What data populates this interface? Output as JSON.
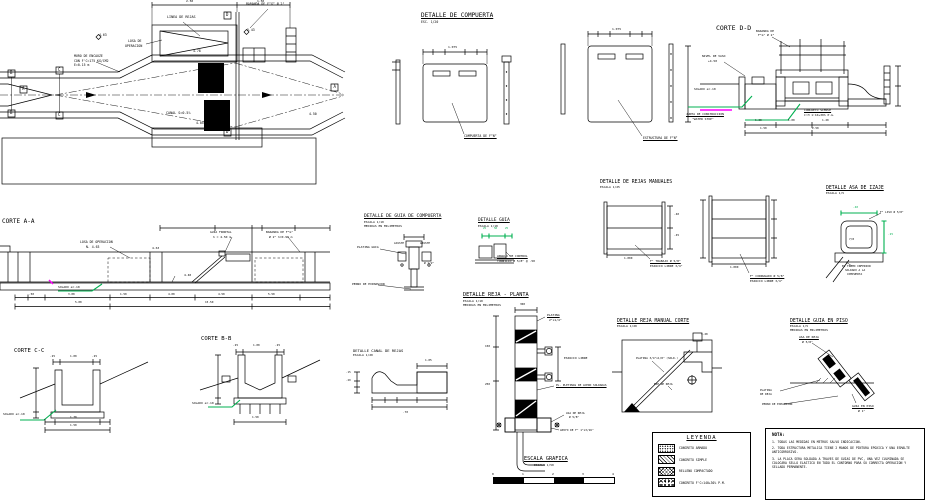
{
  "sheet": {
    "width": 926,
    "height": 501
  },
  "colors": {
    "background": "#ffffff",
    "line": "#000000",
    "green": "#00b050",
    "magenta": "#ff00ff"
  },
  "legend": {
    "title": "LEYENDA",
    "items": [
      {
        "label": "CONCRETO ARMADO",
        "pattern": "stipple"
      },
      {
        "label": "CONCRETO SIMPLE",
        "pattern": "diagonal"
      },
      {
        "label": "RELLENO COMPACTADO",
        "pattern": "crosshatch"
      },
      {
        "label": "CONCRETO F'C=140+30% P.M.",
        "pattern": "rubble"
      }
    ]
  },
  "notes": {
    "title": "NOTA:",
    "items": [
      "1. TODAS LAS MEDIDAS EN METROS SALVO INDICACION.",
      "2. TODA ESTRUCTURA METALICA TIENE 2 MANOS DE PINTURA EPOXICA Y UNA ESMALTE ANTICORROSIVO.",
      "3. LA PLACA SERA SOLDADA A TRAVES DE GUIAS DE PVC, UNA VEZ CULMINADA SE COLOCARA SELLO ELASTICO EN TODO EL CONTORNO PARA SU CORRECTA OPERACION Y SELLADO PERMANENTE."
    ]
  },
  "scale_bar": {
    "ticks": [
      "0",
      "1",
      "2",
      "3",
      "4"
    ]
  },
  "annotations": [
    {
      "n": "title-detalle-de-compuerta",
      "t": "DETALLE DE COMPUERTA",
      "x": 421,
      "y": 13,
      "s": 6,
      "u": 1
    },
    {
      "t": "ESC. 1/20",
      "x": 421,
      "y": 20.5,
      "s": 3.2
    },
    {
      "n": "title-corte-d-d",
      "t": "CORTE D-D",
      "x": 716,
      "y": 25,
      "s": 6.5
    },
    {
      "n": "title-corte-a-a",
      "t": "CORTE A-A",
      "x": 2,
      "y": 219,
      "s": 6
    },
    {
      "n": "title-detalle-de-guia-de-compuerta",
      "t": "DETALLE DE GUIA DE COMPUERTA",
      "x": 364,
      "y": 215,
      "s": 4.6,
      "u": 1
    },
    {
      "t": "ESCALA 1/10",
      "x": 364,
      "y": 221,
      "s": 3
    },
    {
      "t": "MEDIDAS EN MILIMETROS",
      "x": 364,
      "y": 225,
      "s": 3
    },
    {
      "n": "title-detalle-guia",
      "t": "DETALLE GUIA",
      "x": 478,
      "y": 219,
      "s": 4.4,
      "u": 1
    },
    {
      "t": "ESCALA 1/10",
      "x": 478,
      "y": 224.5,
      "s": 3
    },
    {
      "n": "title-detalle-de-rejas-manuales",
      "t": "DETALLE DE REJAS MANUALES",
      "x": 600,
      "y": 180,
      "s": 4.8
    },
    {
      "t": "ESCALA 1/25",
      "x": 600,
      "y": 186,
      "s": 3
    },
    {
      "n": "title-detalle-asa-de-izaje",
      "t": "DETALLE ASA DE IZAJE",
      "x": 826,
      "y": 186,
      "s": 4.8,
      "u": 1
    },
    {
      "t": "ESCALA 1/5",
      "x": 826,
      "y": 192,
      "s": 3
    },
    {
      "n": "title-corte-c-c",
      "t": "CORTE C-C",
      "x": 14,
      "y": 349,
      "s": 5.6
    },
    {
      "n": "title-corte-b-b",
      "t": "CORTE B-B",
      "x": 201,
      "y": 337,
      "s": 5.6
    },
    {
      "n": "title-detalle-canal-de-rejas",
      "t": "DETALLE CANAL DE REJAS",
      "x": 353,
      "y": 349,
      "s": 3.8
    },
    {
      "t": "ESCALA 1/20",
      "x": 353,
      "y": 354,
      "s": 3
    },
    {
      "n": "title-detalle-reja-planta",
      "t": "DETALLE REJA - PLANTA",
      "x": 463,
      "y": 293,
      "s": 5.2,
      "u": 1
    },
    {
      "t": "ESCALA 1/10",
      "x": 463,
      "y": 299.5,
      "s": 3
    },
    {
      "t": "MEDIDAS EN MILIMETROS",
      "x": 463,
      "y": 303.5,
      "s": 3
    },
    {
      "n": "title-detalle-reja-manual-corte",
      "t": "DETALLE REJA MANUAL CORTE",
      "x": 617,
      "y": 319,
      "s": 4.8,
      "u": 1
    },
    {
      "t": "ESCALA 1/20",
      "x": 617,
      "y": 325,
      "s": 3
    },
    {
      "n": "title-detalle-guia-en-piso",
      "t": "DETALLE GUIA EN PISO",
      "x": 790,
      "y": 319,
      "s": 4.8,
      "u": 1
    },
    {
      "t": "ESCALA 1/5",
      "x": 790,
      "y": 325,
      "s": 3
    },
    {
      "t": "MEDIDAS EN MILIMETROS",
      "x": 790,
      "y": 329,
      "s": 3
    },
    {
      "n": "title-escala-grafica",
      "t": "ESCALA GRAFICA",
      "x": 524,
      "y": 457,
      "s": 5.2,
      "u": 1
    },
    {
      "t": "ESCALA 1/50",
      "x": 534,
      "y": 464,
      "s": 3
    },
    {
      "t": "LINEA DE REJAS",
      "x": 167,
      "y": 16,
      "s": 3.4
    },
    {
      "t": "BARANDA DE F°G° Ø 2\"",
      "x": 246,
      "y": 3,
      "s": 3.2
    },
    {
      "t": "LOSA DE",
      "x": 128,
      "y": 40,
      "s": 3.2
    },
    {
      "t": "OPERACION",
      "x": 125,
      "y": 44.5,
      "s": 3.2
    },
    {
      "t": "MURO DE ENCAUZE",
      "x": 74,
      "y": 55,
      "s": 3.2
    },
    {
      "t": "CON F'C=175 KG/CM2",
      "x": 74,
      "y": 59.5,
      "s": 3.2
    },
    {
      "t": "E=0.15 m",
      "x": 74,
      "y": 64,
      "s": 3.2
    },
    {
      "t": "4.63",
      "x": 99,
      "y": 34,
      "s": 3.2
    },
    {
      "t": "5.43",
      "x": 247,
      "y": 29,
      "s": 3.2
    },
    {
      "t": "4.78",
      "x": 193,
      "y": 50,
      "s": 3.2
    },
    {
      "t": "CANAL S=0.5%",
      "x": 166,
      "y": 112,
      "s": 3.4
    },
    {
      "t": "4.05",
      "x": 196,
      "y": 122,
      "s": 3.2
    },
    {
      "t": "4.50",
      "x": 309,
      "y": 113,
      "s": 3.2
    },
    {
      "t": "2.50",
      "x": 186,
      "y": 0,
      "s": 3
    },
    {
      "t": "1.50",
      "x": 257,
      "y": 0,
      "s": 3
    },
    {
      "t": "B",
      "x": 10,
      "y": 70.5,
      "s": 4
    },
    {
      "t": "B",
      "x": 10,
      "y": 110.5,
      "s": 4
    },
    {
      "t": "C",
      "x": 58,
      "y": 67.5,
      "s": 4
    },
    {
      "t": "C",
      "x": 58,
      "y": 112.5,
      "s": 4
    },
    {
      "t": "A",
      "x": 22,
      "y": 86.5,
      "s": 4
    },
    {
      "t": "A",
      "x": 333.5,
      "y": 84.5,
      "s": 4
    },
    {
      "t": "D",
      "x": 226,
      "y": 12.5,
      "s": 4
    },
    {
      "t": "D",
      "x": 226,
      "y": 129.5,
      "s": 4
    },
    {
      "t": "COMPUERTA DE F°N°",
      "x": 464,
      "y": 135,
      "s": 3.2,
      "u": 1
    },
    {
      "t": "ESTRUCTURA DE F°N°",
      "x": 643,
      "y": 137,
      "s": 3.2,
      "u": 1
    },
    {
      "t": "1.075",
      "x": 448,
      "y": 46,
      "s": 3
    },
    {
      "t": "1.075",
      "x": 612,
      "y": 28,
      "s": 3
    },
    {
      "t": "BARANDA DE",
      "x": 756,
      "y": 30,
      "s": 3
    },
    {
      "t": "F°G° Ø 2\"",
      "x": 758,
      "y": 34,
      "s": 3
    },
    {
      "t": "NIVEL DE VASO",
      "x": 702,
      "y": 55,
      "s": 3
    },
    {
      "t": "+4.50",
      "x": 708,
      "y": 59.5,
      "s": 3
    },
    {
      "t": "SOLADO e=.10",
      "x": 694,
      "y": 88,
      "s": 3
    },
    {
      "t": "JUNTA DE CONSTRUCCION",
      "x": 686,
      "y": 113,
      "s": 3,
      "u": 1
    },
    {
      "t": "\"WATER STOP\"",
      "x": 692,
      "y": 117.5,
      "s": 3
    },
    {
      "t": "CONCRETO SIMPLE",
      "x": 804,
      "y": 109,
      "s": 3,
      "u": 1
    },
    {
      "t": "C:H 1:10+30% P.G.",
      "x": 804,
      "y": 113.5,
      "s": 3
    },
    {
      "t": "1.20",
      "x": 755,
      "y": 119,
      "s": 2.8
    },
    {
      "t": "1.00",
      "x": 788,
      "y": 119,
      "s": 2.8
    },
    {
      "t": "1.20",
      "x": 822,
      "y": 119,
      "s": 2.8
    },
    {
      "t": "1.50",
      "x": 760,
      "y": 127,
      "s": 2.8
    },
    {
      "t": "2.50",
      "x": 812,
      "y": 127,
      "s": 2.8
    },
    {
      "t": "LOSA DE OPERACION",
      "x": 80,
      "y": 241,
      "s": 3.2
    },
    {
      "t": "N. 4.63",
      "x": 86,
      "y": 245.5,
      "s": 3.2
    },
    {
      "t": "GUIA FRONTAL",
      "x": 210,
      "y": 231,
      "s": 3
    },
    {
      "t": "h = 4.50 m",
      "x": 213,
      "y": 235.5,
      "s": 3
    },
    {
      "t": "BARANDA DE F°G°",
      "x": 266,
      "y": 231,
      "s": 3
    },
    {
      "t": "Ø 2\" h=0.90 m",
      "x": 269,
      "y": 235.5,
      "s": 3
    },
    {
      "t": "4.63",
      "x": 152,
      "y": 247,
      "s": 3
    },
    {
      "t": "4.40",
      "x": 184,
      "y": 274,
      "s": 3
    },
    {
      "t": "SOLADO e=.10",
      "x": 58,
      "y": 286,
      "s": 3
    },
    {
      "t": ".50",
      "x": 29,
      "y": 293,
      "s": 2.8
    },
    {
      "t": "3.00",
      "x": 68,
      "y": 293,
      "s": 2.8
    },
    {
      "t": "1.50",
      "x": 120,
      "y": 293,
      "s": 2.8
    },
    {
      "t": "4.00",
      "x": 168,
      "y": 293,
      "s": 2.8
    },
    {
      "t": "4.50",
      "x": 218,
      "y": 293,
      "s": 2.8
    },
    {
      "t": "5.50",
      "x": 268,
      "y": 293,
      "s": 2.8
    },
    {
      "t": "5.00",
      "x": 75,
      "y": 301,
      "s": 2.8
    },
    {
      "t": "15.50",
      "x": 205,
      "y": 301,
      "s": 2.8
    },
    {
      "t": "PLATINA GUIA",
      "x": 357,
      "y": 246,
      "s": 3
    },
    {
      "t": "AJUSTE",
      "x": 394,
      "y": 242,
      "s": 2.8
    },
    {
      "t": "AJUSTE",
      "x": 420,
      "y": 242,
      "s": 2.8
    },
    {
      "t": "Ø 1/2\"",
      "x": 424,
      "y": 262,
      "s": 2.8
    },
    {
      "t": "PERNO DE EXPANSION",
      "x": 352,
      "y": 283,
      "s": 3
    },
    {
      "t": "25",
      "x": 483,
      "y": 228,
      "s": 2.6,
      "c": "g"
    },
    {
      "t": "50",
      "x": 494,
      "y": 228,
      "s": 2.6,
      "c": "g"
    },
    {
      "t": "25",
      "x": 505,
      "y": 228,
      "s": 2.6,
      "c": "g"
    },
    {
      "t": "ANGULO DE CONTROL",
      "x": 497,
      "y": 255,
      "s": 3,
      "u": 1
    },
    {
      "t": "TORNILLO Ø 5/8\" @ .50",
      "x": 497,
      "y": 259.5,
      "s": 3
    },
    {
      "t": "F° TRABAJO Ø 5/8\"",
      "x": 650,
      "y": 260,
      "s": 3,
      "u": 1
    },
    {
      "t": "ESPACIO LIBRE 3/4\"",
      "x": 650,
      "y": 264.5,
      "s": 3
    },
    {
      "t": "1.000",
      "x": 624,
      "y": 256.5,
      "s": 2.8
    },
    {
      "t": "F° CORRUGADO Ø 5/8\"",
      "x": 750,
      "y": 275,
      "s": 3,
      "u": 1
    },
    {
      "t": "ESPACIO LIBRE 3/4\"",
      "x": 750,
      "y": 279.5,
      "s": 3
    },
    {
      "t": "1.000",
      "x": 730,
      "y": 266,
      "s": 2.8
    },
    {
      "t": ".40",
      "x": 674,
      "y": 213,
      "s": 2.8
    },
    {
      "t": ".45",
      "x": 674,
      "y": 234,
      "s": 2.8
    },
    {
      "t": ".40",
      "x": 853,
      "y": 206,
      "s": 2.8,
      "c": "g"
    },
    {
      "t": ".25",
      "x": 888,
      "y": 233,
      "s": 2.8,
      "c": "g"
    },
    {
      "t": "F° LISO Ø 5/8\"",
      "x": 880,
      "y": 211,
      "s": 2.8
    },
    {
      "t": "7/8",
      "x": 849,
      "y": 238,
      "s": 2.8
    },
    {
      "t": "EL TRAMO INFERIOR",
      "x": 842,
      "y": 265,
      "s": 2.8
    },
    {
      "t": "SOLDADO A LA",
      "x": 845,
      "y": 269,
      "s": 2.8
    },
    {
      "t": "COMPUERTA",
      "x": 847,
      "y": 273,
      "s": 2.8
    },
    {
      "t": ".25",
      "x": 50,
      "y": 355,
      "s": 2.8
    },
    {
      "t": "1.00",
      "x": 70,
      "y": 355,
      "s": 2.8
    },
    {
      "t": ".25",
      "x": 92,
      "y": 355,
      "s": 2.8
    },
    {
      "t": "SOLADO e=.10",
      "x": 3,
      "y": 413,
      "s": 3
    },
    {
      "t": "1.30",
      "x": 70,
      "y": 415.5,
      "s": 2.8
    },
    {
      "t": "1.50",
      "x": 70,
      "y": 424,
      "s": 2.8
    },
    {
      "t": ".25",
      "x": 233,
      "y": 344,
      "s": 2.8
    },
    {
      "t": "1.00",
      "x": 253,
      "y": 344,
      "s": 2.8
    },
    {
      "t": ".25",
      "x": 275,
      "y": 344,
      "s": 2.8
    },
    {
      "t": "SOLADO e=.10",
      "x": 192,
      "y": 402,
      "s": 3
    },
    {
      "t": "1.50",
      "x": 252,
      "y": 415.5,
      "s": 2.8
    },
    {
      "t": "1.05",
      "x": 425,
      "y": 359,
      "s": 2.8
    },
    {
      "t": ".15",
      "x": 346,
      "y": 372,
      "s": 2.6
    },
    {
      "t": ".20",
      "x": 346,
      "y": 380,
      "s": 2.6
    },
    {
      "t": ".70",
      "x": 403,
      "y": 410.5,
      "s": 2.8
    },
    {
      "t": "300",
      "x": 520,
      "y": 302.5,
      "s": 2.8
    },
    {
      "t": "PLATINA",
      "x": 547,
      "y": 314,
      "s": 3,
      "u": 1
    },
    {
      "t": "2\"x1/4\"",
      "x": 549,
      "y": 318.5,
      "s": 3
    },
    {
      "t": "ESPACIO LIBRE",
      "x": 564,
      "y": 357,
      "s": 3
    },
    {
      "t": "PL. PLETINAS DE ACERO SOLDADAS",
      "x": 556,
      "y": 384,
      "s": 2.8,
      "u": 1
    },
    {
      "t": "ASA DE REJA",
      "x": 566,
      "y": 412,
      "s": 2.8
    },
    {
      "t": "Ø 5/8\"",
      "x": 569,
      "y": 416,
      "s": 2.8
    },
    {
      "t": "APOYO DE F° 1\"x3/16\"",
      "x": 560,
      "y": 429,
      "s": 2.8
    },
    {
      "t": "150",
      "x": 485,
      "y": 345,
      "s": 2.8
    },
    {
      "t": "250",
      "x": 485,
      "y": 383,
      "s": 2.8
    },
    {
      "t": "PLATINA 3/4\"x1/8\" (SOLD.)",
      "x": 636,
      "y": 357,
      "s": 2.8
    },
    {
      "t": "EJE DE REJA",
      "x": 654,
      "y": 383,
      "s": 2.8
    },
    {
      "t": "1.20",
      "x": 701,
      "y": 333,
      "s": 2.8
    },
    {
      "t": "ASA DE REJA",
      "x": 799,
      "y": 336,
      "s": 3,
      "u": 1
    },
    {
      "t": "Ø 5/8\"",
      "x": 802,
      "y": 340.5,
      "s": 3
    },
    {
      "t": "PLATINA",
      "x": 760,
      "y": 389,
      "s": 2.8
    },
    {
      "t": "DE REJA",
      "x": 760,
      "y": 393,
      "s": 2.8
    },
    {
      "t": "PERNO DE EXPANSION",
      "x": 762,
      "y": 403,
      "s": 2.8
    },
    {
      "t": "GUIA EN PISO",
      "x": 852,
      "y": 405,
      "s": 3,
      "u": 1
    },
    {
      "t": "Ø 1\"",
      "x": 858,
      "y": 409.5,
      "s": 3
    }
  ]
}
